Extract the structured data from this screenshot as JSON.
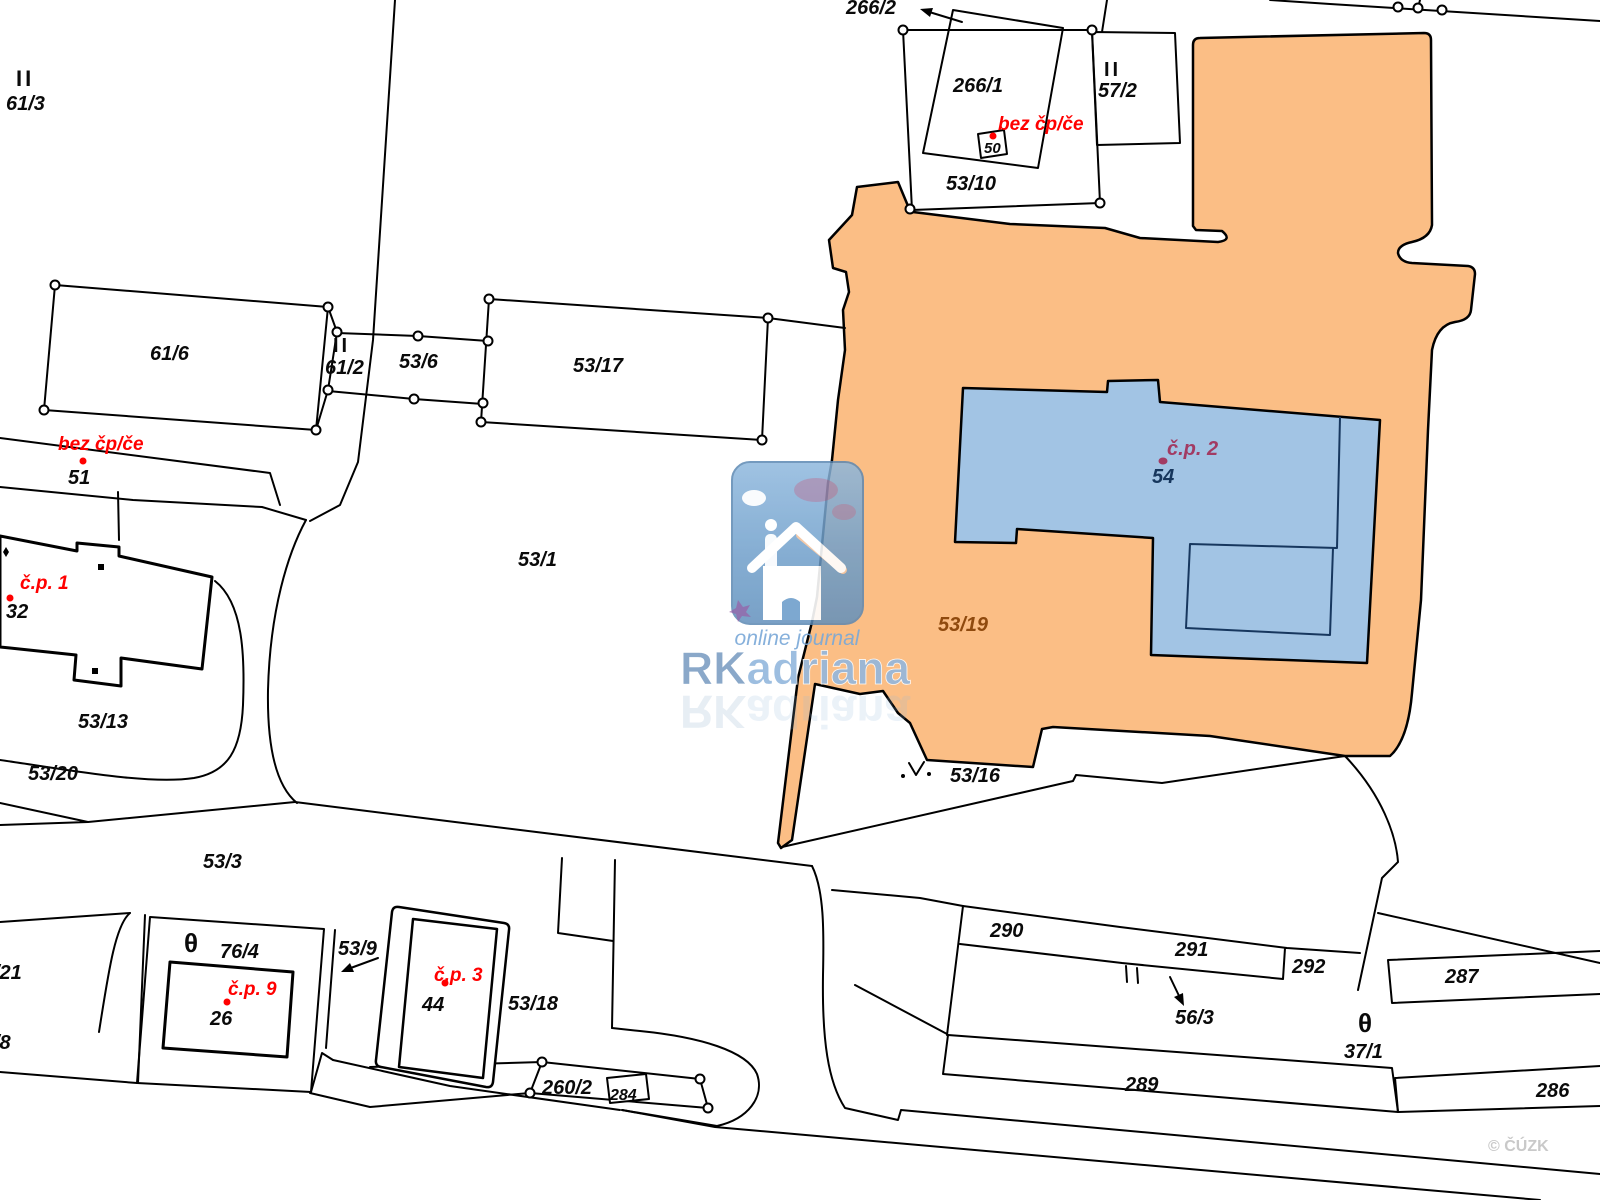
{
  "map": {
    "type": "cadastral-map",
    "highlight_colors": {
      "parcel_53_19_fill": "#FBBE85",
      "building_54_fill": "#A2C4E4",
      "building_54_inner_line": "#17375E",
      "red_label": "#FF0000",
      "maroon_label": "#A23B63",
      "navy_label": "#16365C",
      "brown_label": "#8F4A0E",
      "copyright_gray": "#C9C9C9"
    },
    "watermark": {
      "tagline": "online journal",
      "brand_prefix": "RK",
      "brand_suffix": "adriana"
    },
    "copyright": "© ČÚZK",
    "labels": [
      {
        "t": "II",
        "x": 16,
        "y": 86,
        "s": 22,
        "it": false,
        "ls": 3
      },
      {
        "t": "61/3",
        "x": 6,
        "y": 110
      },
      {
        "t": "266/2",
        "x": 846,
        "y": 14
      },
      {
        "t": "266/1",
        "x": 953,
        "y": 92
      },
      {
        "t": "bez čp/če",
        "x": 998,
        "y": 130,
        "s": 19,
        "c": "#FF0000"
      },
      {
        "t": "50",
        "x": 984,
        "y": 153,
        "s": 15
      },
      {
        "t": "53/10",
        "x": 946,
        "y": 190
      },
      {
        "t": "II",
        "x": 1104,
        "y": 76,
        "s": 20,
        "it": false,
        "ls": 3
      },
      {
        "t": "57/2",
        "x": 1098,
        "y": 97
      },
      {
        "t": "61/6",
        "x": 150,
        "y": 360
      },
      {
        "t": "II",
        "x": 333,
        "y": 352,
        "s": 20,
        "it": false,
        "ls": 3
      },
      {
        "t": "61/2",
        "x": 325,
        "y": 374
      },
      {
        "t": "53/6",
        "x": 399,
        "y": 368
      },
      {
        "t": "53/17",
        "x": 573,
        "y": 372
      },
      {
        "t": "bez čp/če",
        "x": 58,
        "y": 450,
        "s": 19,
        "c": "#FF0000"
      },
      {
        "t": "51",
        "x": 68,
        "y": 484
      },
      {
        "t": "č.p. 1",
        "x": 20,
        "y": 589,
        "s": 19,
        "c": "#FF0000"
      },
      {
        "t": "32",
        "x": 6,
        "y": 618
      },
      {
        "t": "53/1",
        "x": 518,
        "y": 566
      },
      {
        "t": "č.p. 2",
        "x": 1167,
        "y": 455,
        "s": 20,
        "c": "#A23B63"
      },
      {
        "t": "54",
        "x": 1152,
        "y": 483,
        "c": "#16365C"
      },
      {
        "t": "53/19",
        "x": 938,
        "y": 631,
        "c": "#8F4A0E"
      },
      {
        "t": "53/13",
        "x": 78,
        "y": 728
      },
      {
        "t": "53/20",
        "x": 28,
        "y": 780
      },
      {
        "t": "53/16",
        "x": 950,
        "y": 782
      },
      {
        "t": "53/3",
        "x": 203,
        "y": 868
      },
      {
        "t": "/21",
        "x": -6,
        "y": 979
      },
      {
        "t": "/8",
        "x": -6,
        "y": 1049
      },
      {
        "t": "θ",
        "x": 184,
        "y": 952,
        "s": 26,
        "it": false
      },
      {
        "t": "76/4",
        "x": 220,
        "y": 958
      },
      {
        "t": "53/9",
        "x": 338,
        "y": 955
      },
      {
        "t": "č.p. 9",
        "x": 228,
        "y": 995,
        "s": 19,
        "c": "#FF0000"
      },
      {
        "t": "26",
        "x": 210,
        "y": 1025
      },
      {
        "t": "č.p. 3",
        "x": 434,
        "y": 981,
        "s": 19,
        "c": "#FF0000"
      },
      {
        "t": "44",
        "x": 422,
        "y": 1011
      },
      {
        "t": "53/18",
        "x": 508,
        "y": 1010
      },
      {
        "t": "260/2",
        "x": 542,
        "y": 1094
      },
      {
        "t": "284",
        "x": 610,
        "y": 1100,
        "s": 16
      },
      {
        "t": "290",
        "x": 990,
        "y": 937
      },
      {
        "t": "291",
        "x": 1175,
        "y": 956
      },
      {
        "t": "292",
        "x": 1292,
        "y": 973
      },
      {
        "t": "287",
        "x": 1445,
        "y": 983
      },
      {
        "t": "56/3",
        "x": 1175,
        "y": 1024
      },
      {
        "t": "θ",
        "x": 1358,
        "y": 1032,
        "s": 26,
        "it": false
      },
      {
        "t": "37/1",
        "x": 1344,
        "y": 1058
      },
      {
        "t": "289",
        "x": 1125,
        "y": 1091
      },
      {
        "t": "286",
        "x": 1536,
        "y": 1097
      },
      {
        "t": "© ČÚZK",
        "x": 1488,
        "y": 1151,
        "s": 16,
        "it": false,
        "c": "#C9C9C9"
      }
    ],
    "red_point_markers": [
      {
        "x": 83,
        "y": 461
      },
      {
        "x": 10,
        "y": 598
      },
      {
        "x": 993,
        "y": 136
      },
      {
        "x": 227,
        "y": 1002
      },
      {
        "x": 445,
        "y": 983
      }
    ],
    "maroon_point_marker": {
      "x": 1163,
      "y": 461
    },
    "vertex_circles": [
      [
        55,
        285
      ],
      [
        328,
        307
      ],
      [
        44,
        410
      ],
      [
        316,
        430
      ],
      [
        337,
        332
      ],
      [
        328,
        390
      ],
      [
        418,
        336
      ],
      [
        414,
        399
      ],
      [
        489,
        299
      ],
      [
        488,
        341
      ],
      [
        483,
        403
      ],
      [
        481,
        422
      ],
      [
        768,
        318
      ],
      [
        762,
        440
      ],
      [
        903,
        30
      ],
      [
        1092,
        30
      ],
      [
        1100,
        203
      ],
      [
        910,
        209
      ],
      [
        1398,
        7
      ],
      [
        1418,
        8
      ],
      [
        1442,
        10
      ],
      [
        542,
        1062
      ],
      [
        530,
        1093
      ],
      [
        700,
        1079
      ],
      [
        708,
        1108
      ]
    ]
  }
}
